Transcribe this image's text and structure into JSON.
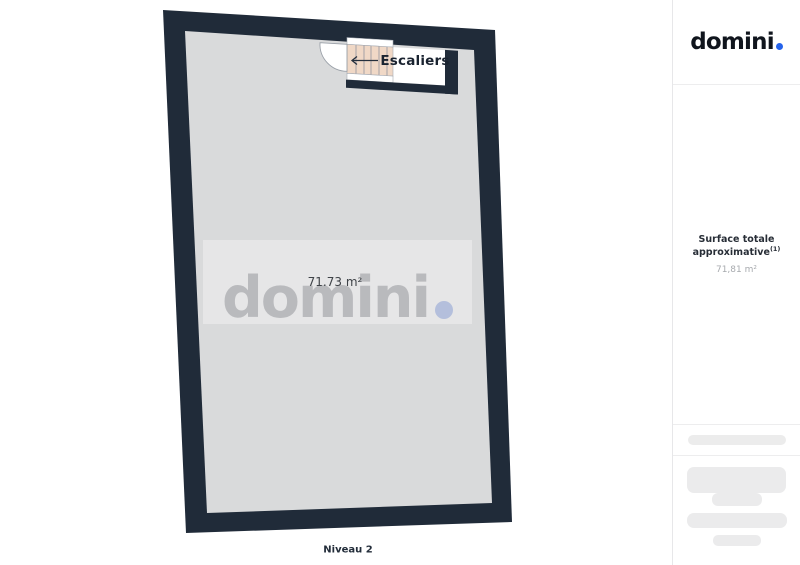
{
  "brand": {
    "logo_text": "domini"
  },
  "sidebar": {
    "surface": {
      "label": "Surface totale approximative",
      "footnote_marker": "(1)",
      "value": "71,81 m²"
    }
  },
  "plan": {
    "stairs_label": "Escaliers",
    "area_label": "71.73 m²",
    "level_label": "Niveau 2",
    "watermark_text": "domini"
  },
  "theme": {
    "accent": "#2563eb",
    "wall": "#202b39",
    "floor": "#d9dadb",
    "stairs": "#f0d8c6",
    "watermark-letter": "#b9babd",
    "watermark-dot": "#b4bfdc"
  }
}
